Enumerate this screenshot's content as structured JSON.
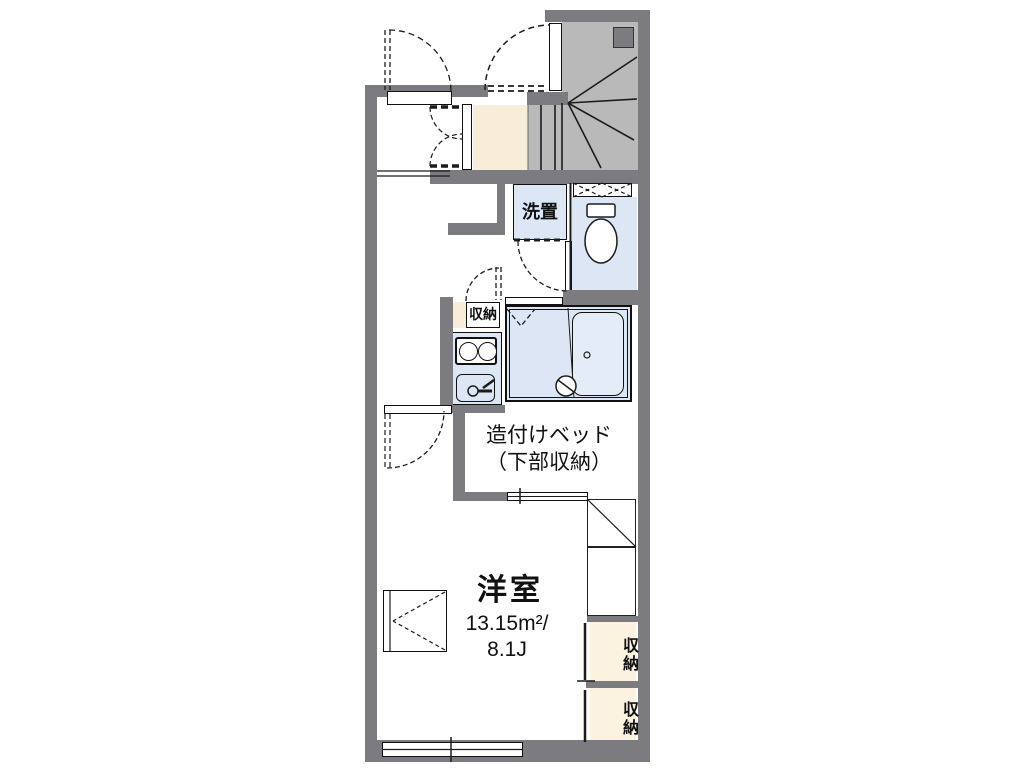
{
  "plan": {
    "title": "floor-plan",
    "room": {
      "name": "洋室",
      "area": "13.15m²/",
      "tatami": "8.1J"
    },
    "bed": {
      "line1": "造付けベッド",
      "line2": "（下部収納）"
    },
    "laundry": {
      "label": "洗置"
    },
    "kitchen_storage": {
      "label": "収納"
    },
    "closet_right_top": {
      "label": "収納"
    },
    "closet_right_bottom": {
      "label": "収納"
    },
    "icons": [
      "stairs-icon",
      "toilet-icon",
      "stove-icon",
      "sink-faucet-icon",
      "shower-icon",
      "bathtub-icon",
      "refrigerator-space-icon",
      "window-icon",
      "door-swing-icon"
    ],
    "colors": {
      "wall": "#7b7b80",
      "stair_fill": "#b9b9b9",
      "water_area": "#dce6f5",
      "entrance_cream": "#f8edd8",
      "storage_beige": "#fbf2df",
      "line": "#1c1c1c",
      "background": "#ffffff"
    }
  }
}
